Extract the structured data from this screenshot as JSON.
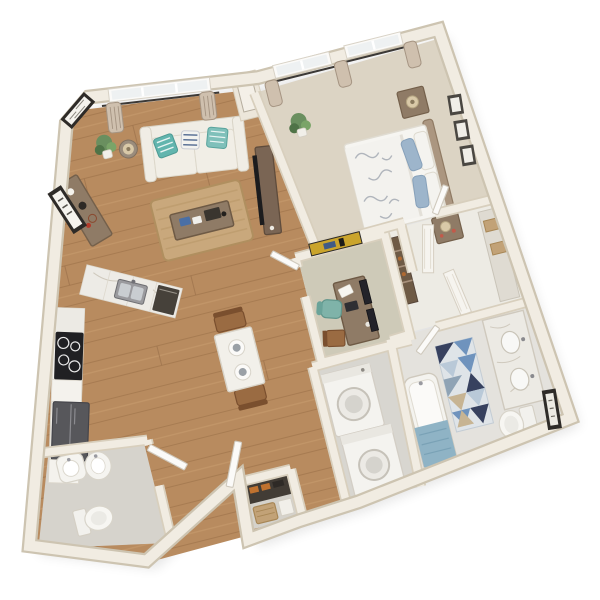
{
  "scene": {
    "label": "3D top-down floor plan render of a one-bedroom apartment with den",
    "background": "#ffffff"
  },
  "palette": {
    "wall": "#f1ece2",
    "wallEdge": "#d8cfbd",
    "shadow": "#000000",
    "wood": "#b88b5f",
    "woodLineLight": "#c99e70",
    "woodLineDark": "#9a7048",
    "carpetBedroom": "#dcd4c4",
    "carpetDen": "#cecab8",
    "bathFloor": "#e4e2dd",
    "laundryFloor": "#d8d6d0",
    "powderFloor": "#d6d3cc",
    "closetFloor": "#edebe4",
    "entryClosetFloor": "#d5d2cb",
    "marble": "#eceae4",
    "marbleVein": "#cfc9bd",
    "rangeBlack": "#202023",
    "applianceDark": "#57575b",
    "rugJute": "#c9a87c",
    "rugJuteEdge": "#b08f5f",
    "sofa": "#f0ede5",
    "accentTeal": "#62b5ae",
    "accentNavy": "#3f5a86",
    "bedLinen": "#f6f5f1",
    "accentBlue": "#9db5cb",
    "duvetLeaf": "#a9aeb6",
    "headboard": "#ab9680",
    "woodFurniture": "#8f7b66",
    "woodFurnitureDark": "#6e5a45",
    "walnut": "#7a6554",
    "tvBlack": "#1c1c1e",
    "towel": "#8fb3c5",
    "tealChair": "#7fb3a9",
    "oakChair": "#9a6b42",
    "fixtureWhite": "#f7f6f2",
    "fixtureStroke": "#d4cfc4",
    "artDark": "#2e2b28",
    "artGold": "#caa42c",
    "curtain": "#cfc0ae",
    "curtainStripe": "#a59482",
    "glass": "#eef1f2",
    "rod": "#3c3936",
    "rugTriBlue": "#6f93bd",
    "rugTriLight": "#b9c9d8",
    "rugTriNavy": "#37415f",
    "rugTriTan": "#c7b493",
    "rugTriGray": "#8fa3b5",
    "rugTriBase": "#dfe4e8",
    "basket": "#c2a277",
    "basketEdge": "#a88756",
    "shoeOrange": "#c0722f",
    "shelfDark": "#423c35",
    "plant": "#6a8f5f",
    "plantDark": "#4f7347",
    "lampShade": "#d9c9a8",
    "lampBase": "#8a7a5e"
  },
  "rooms": [
    {
      "id": "living-room",
      "label": "Living Room",
      "flooring": "hardwood",
      "furniture": [
        "sofa with teal pillows",
        "coffee table",
        "jute area rug",
        "media console with TV",
        "sideboard",
        "side table with lamp",
        "floor plant",
        "framed wall art"
      ]
    },
    {
      "id": "bedroom",
      "label": "Bedroom",
      "flooring": "carpet",
      "furniture": [
        "queen bed with floral duvet",
        "nightstand with lamp (window side)",
        "nightstand with lamp (foot side)",
        "gallery of three frames",
        "potted plant",
        "curtained windows"
      ]
    },
    {
      "id": "kitchen",
      "label": "Kitchen",
      "flooring": "hardwood",
      "furniture": [
        "marble sink counter",
        "range with cooktop",
        "wall oven",
        "refrigerator",
        "white cabinetry"
      ]
    },
    {
      "id": "dining-nook",
      "label": "Dining Nook",
      "flooring": "hardwood",
      "furniture": [
        "two-seat table with place settings",
        "two wooden chairs"
      ]
    },
    {
      "id": "den-office",
      "label": "Den / Office",
      "flooring": "carpet",
      "furniture": [
        "desk with laptop and monitors",
        "teal task chair",
        "wooden side chair",
        "long gold wall art",
        "open shelf cabinet"
      ]
    },
    {
      "id": "walk-in-closet",
      "label": "Walk-in Closet",
      "flooring": "tile",
      "furniture": [
        "shelf with storage boxes",
        "white bifold doors"
      ]
    },
    {
      "id": "bathroom",
      "label": "Bathroom",
      "flooring": "tile",
      "furniture": [
        "double marble vanity",
        "toilet",
        "bathtub with blue towel",
        "geometric triangle rug",
        "framed art"
      ]
    },
    {
      "id": "laundry-closet",
      "label": "Laundry",
      "flooring": "tile",
      "furniture": [
        "stacked washer and dryer"
      ]
    },
    {
      "id": "powder-room",
      "label": "Powder Room",
      "flooring": "tile",
      "furniture": [
        "pedestal sinks",
        "toilet",
        "swing door"
      ]
    },
    {
      "id": "entry",
      "label": "Entry",
      "flooring": "hardwood",
      "furniture": [
        "front door ajar",
        "entry closet with shoe shelf and basket"
      ]
    }
  ]
}
